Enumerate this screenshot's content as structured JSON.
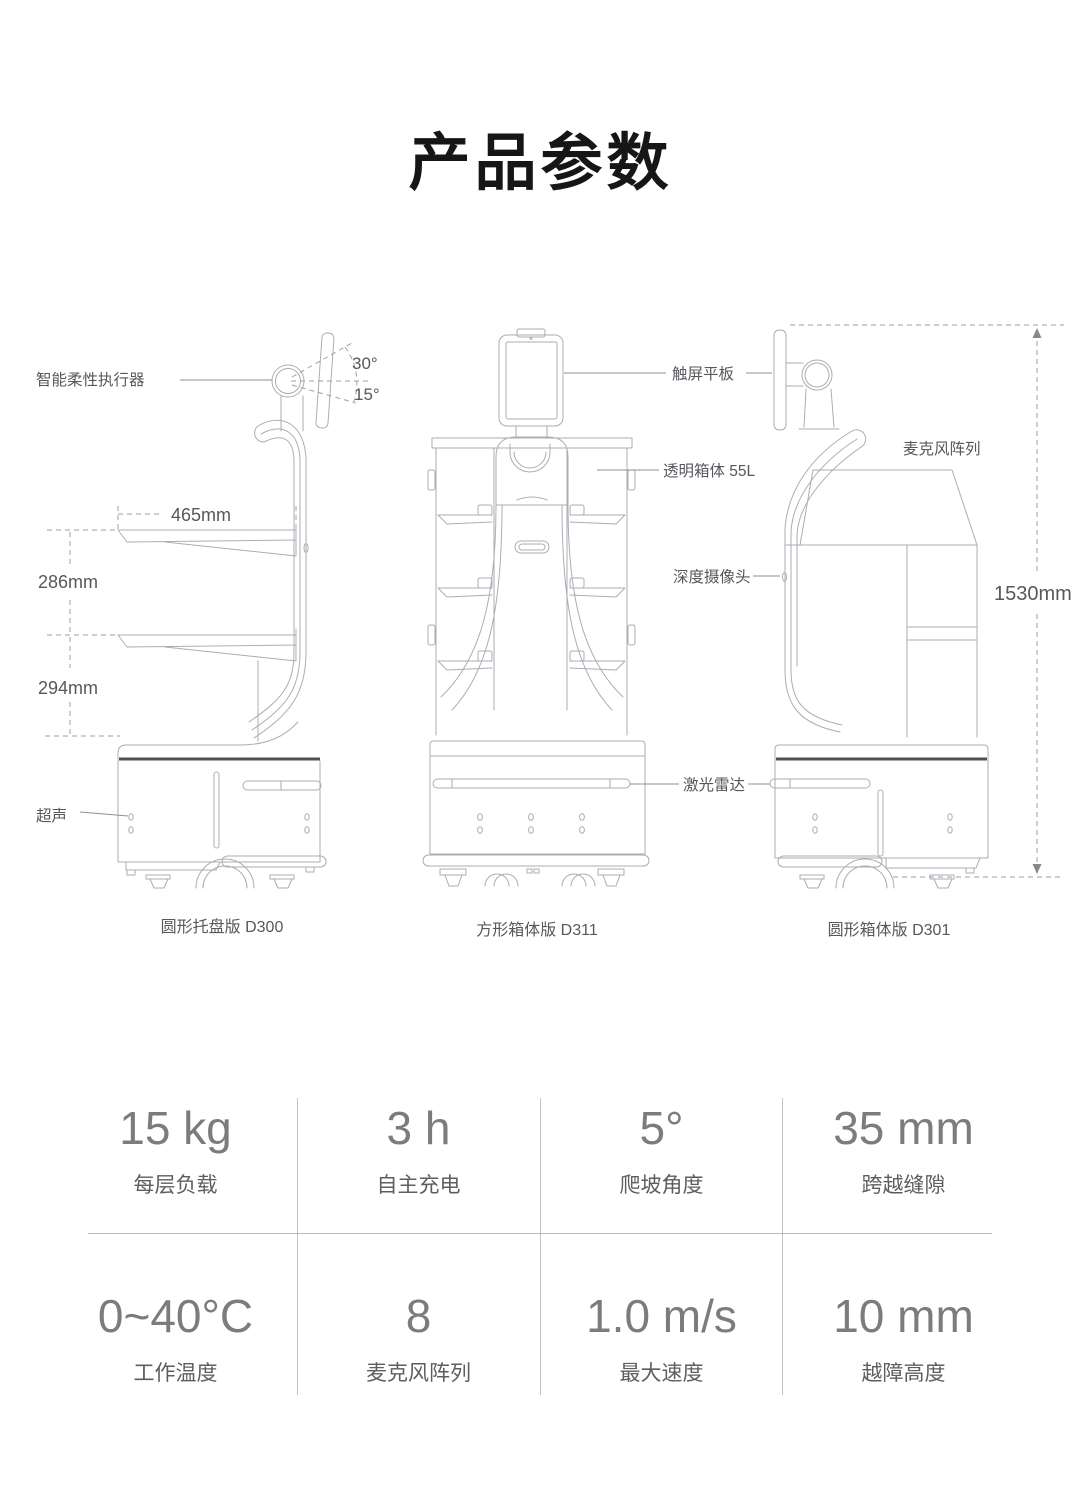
{
  "page": {
    "title": "产品参数",
    "background": "#ffffff"
  },
  "diagram": {
    "line_color": "#a9aeb3",
    "label_color": "#55585c",
    "annotations": {
      "actuator": "智能柔性执行器",
      "ultrasonic": "超声",
      "touchscreen": "触屏平板",
      "transparent_box": "透明箱体 55L",
      "depth_camera": "深度摄像头",
      "lidar": "激光雷达",
      "mic_array": "麦克风阵列"
    },
    "dimensions": {
      "tilt_up": "30°",
      "tilt_down": "15°",
      "tray_width": "465mm",
      "shelf_gap_upper": "286mm",
      "shelf_gap_lower": "294mm",
      "total_height": "1530mm"
    },
    "robots": [
      {
        "caption": "圆形托盘版 D300"
      },
      {
        "caption": "方形箱体版 D311"
      },
      {
        "caption": "圆形箱体版 D301"
      }
    ]
  },
  "specs": {
    "value_color": "#7c7c7c",
    "label_color": "#5e5e5e",
    "divider_color": "#c3c3c3",
    "rows": [
      [
        {
          "value": "15 kg",
          "label": "每层负载"
        },
        {
          "value": "3 h",
          "label": "自主充电"
        },
        {
          "value": "5°",
          "label": "爬坡角度"
        },
        {
          "value": "35 mm",
          "label": "跨越缝隙"
        }
      ],
      [
        {
          "value": "0~40°C",
          "label": "工作温度"
        },
        {
          "value": "8",
          "label": "麦克风阵列"
        },
        {
          "value": "1.0 m/s",
          "label": "最大速度"
        },
        {
          "value": "10 mm",
          "label": "越障高度"
        }
      ]
    ]
  }
}
